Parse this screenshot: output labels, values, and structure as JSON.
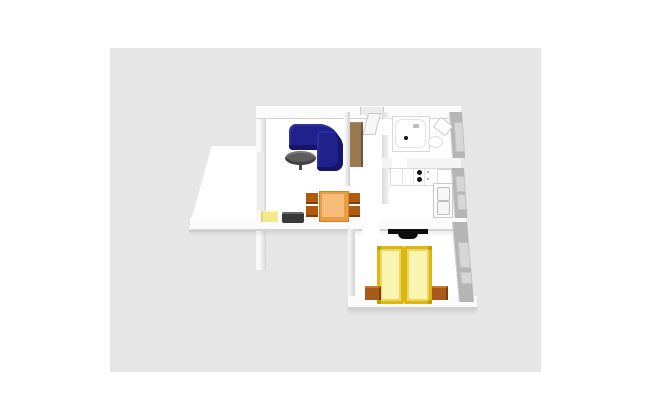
{
  "scene": {
    "kind": "3d-floorplan-render",
    "rooms": [
      {
        "name": "living-room",
        "furniture": [
          "corner-sofa",
          "coffee-table",
          "dining-table",
          "dining-chairs",
          "sideboard",
          "tv-lowboard"
        ]
      },
      {
        "name": "hallway",
        "furniture": [
          "shelf",
          "entry-door"
        ]
      },
      {
        "name": "bathroom",
        "furniture": [
          "bathtub",
          "washbasin",
          "toilet"
        ]
      },
      {
        "name": "kitchen",
        "furniture": [
          "counter",
          "stove",
          "tall-cabinet"
        ]
      },
      {
        "name": "bedroom",
        "furniture": [
          "double-bed",
          "nightstand-left",
          "nightstand-right",
          "wardrobe"
        ]
      },
      {
        "name": "terrace",
        "furniture": []
      }
    ]
  },
  "colors": {
    "canvas_bg": "#e6e6e6",
    "floor": "#ffffff",
    "sofa": "#21218c",
    "coffee_table": "#5d5d5d",
    "shelf": "#9a7850",
    "dining_table": "#eb9c43",
    "dining_table_top": "#f5bd77",
    "chair": "#b05a10",
    "sideboard": "#f4e98c",
    "tv_board": "#383838",
    "burner": "#111111",
    "drain": "#111111",
    "wardrobe": "#0e0e0e",
    "bed_frame": "#dcb70e",
    "mattress": "#f9f5b1",
    "nightstand": "#a8591c",
    "outer_wall": "#b5b5b5",
    "window": "#d6d6d6"
  }
}
